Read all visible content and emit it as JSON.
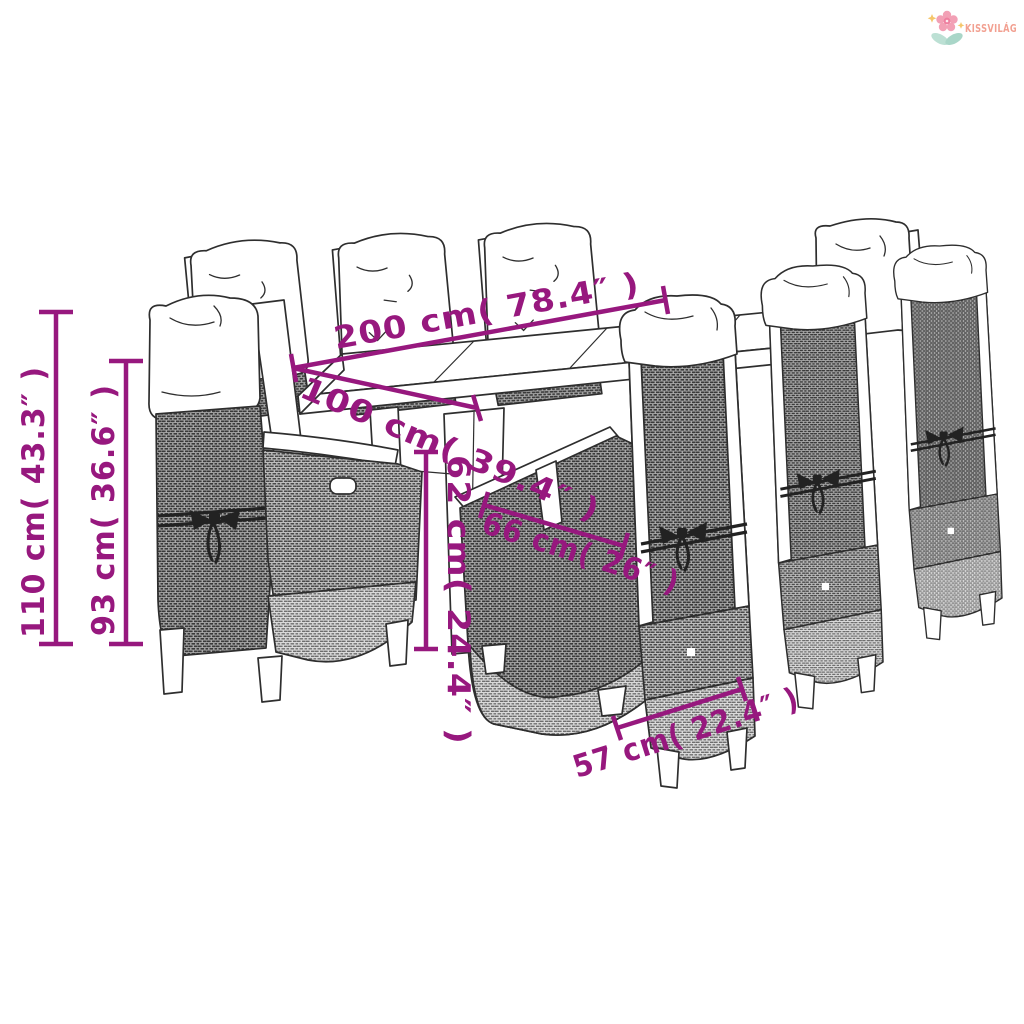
{
  "logo": {
    "brand": "KISSVILÁG",
    "icon": "flower-icon"
  },
  "dimensions": {
    "table_length": "200 cm( 78.4″ )",
    "table_width": "100 cm( 39.4″ )",
    "table_clearance_height": "62 cm( 24.4″ )",
    "chair_depth": "66 cm( 26″ )",
    "chair_width": "57 cm( 22.4″ )",
    "chair_total_height": "110 cm( 43.3″ )",
    "chair_back_height": "93 cm( 36.6″ )"
  },
  "colors": {
    "dimension_accent": "#97187E",
    "logo_text": "#F2A091",
    "logo_flower": "#F2A0B5",
    "logo_flower_core": "#EE7F9F",
    "logo_leaf": "#AFD9CD",
    "logo_sparkle": "#F5C66B",
    "line_art": "#2E2E2E"
  }
}
